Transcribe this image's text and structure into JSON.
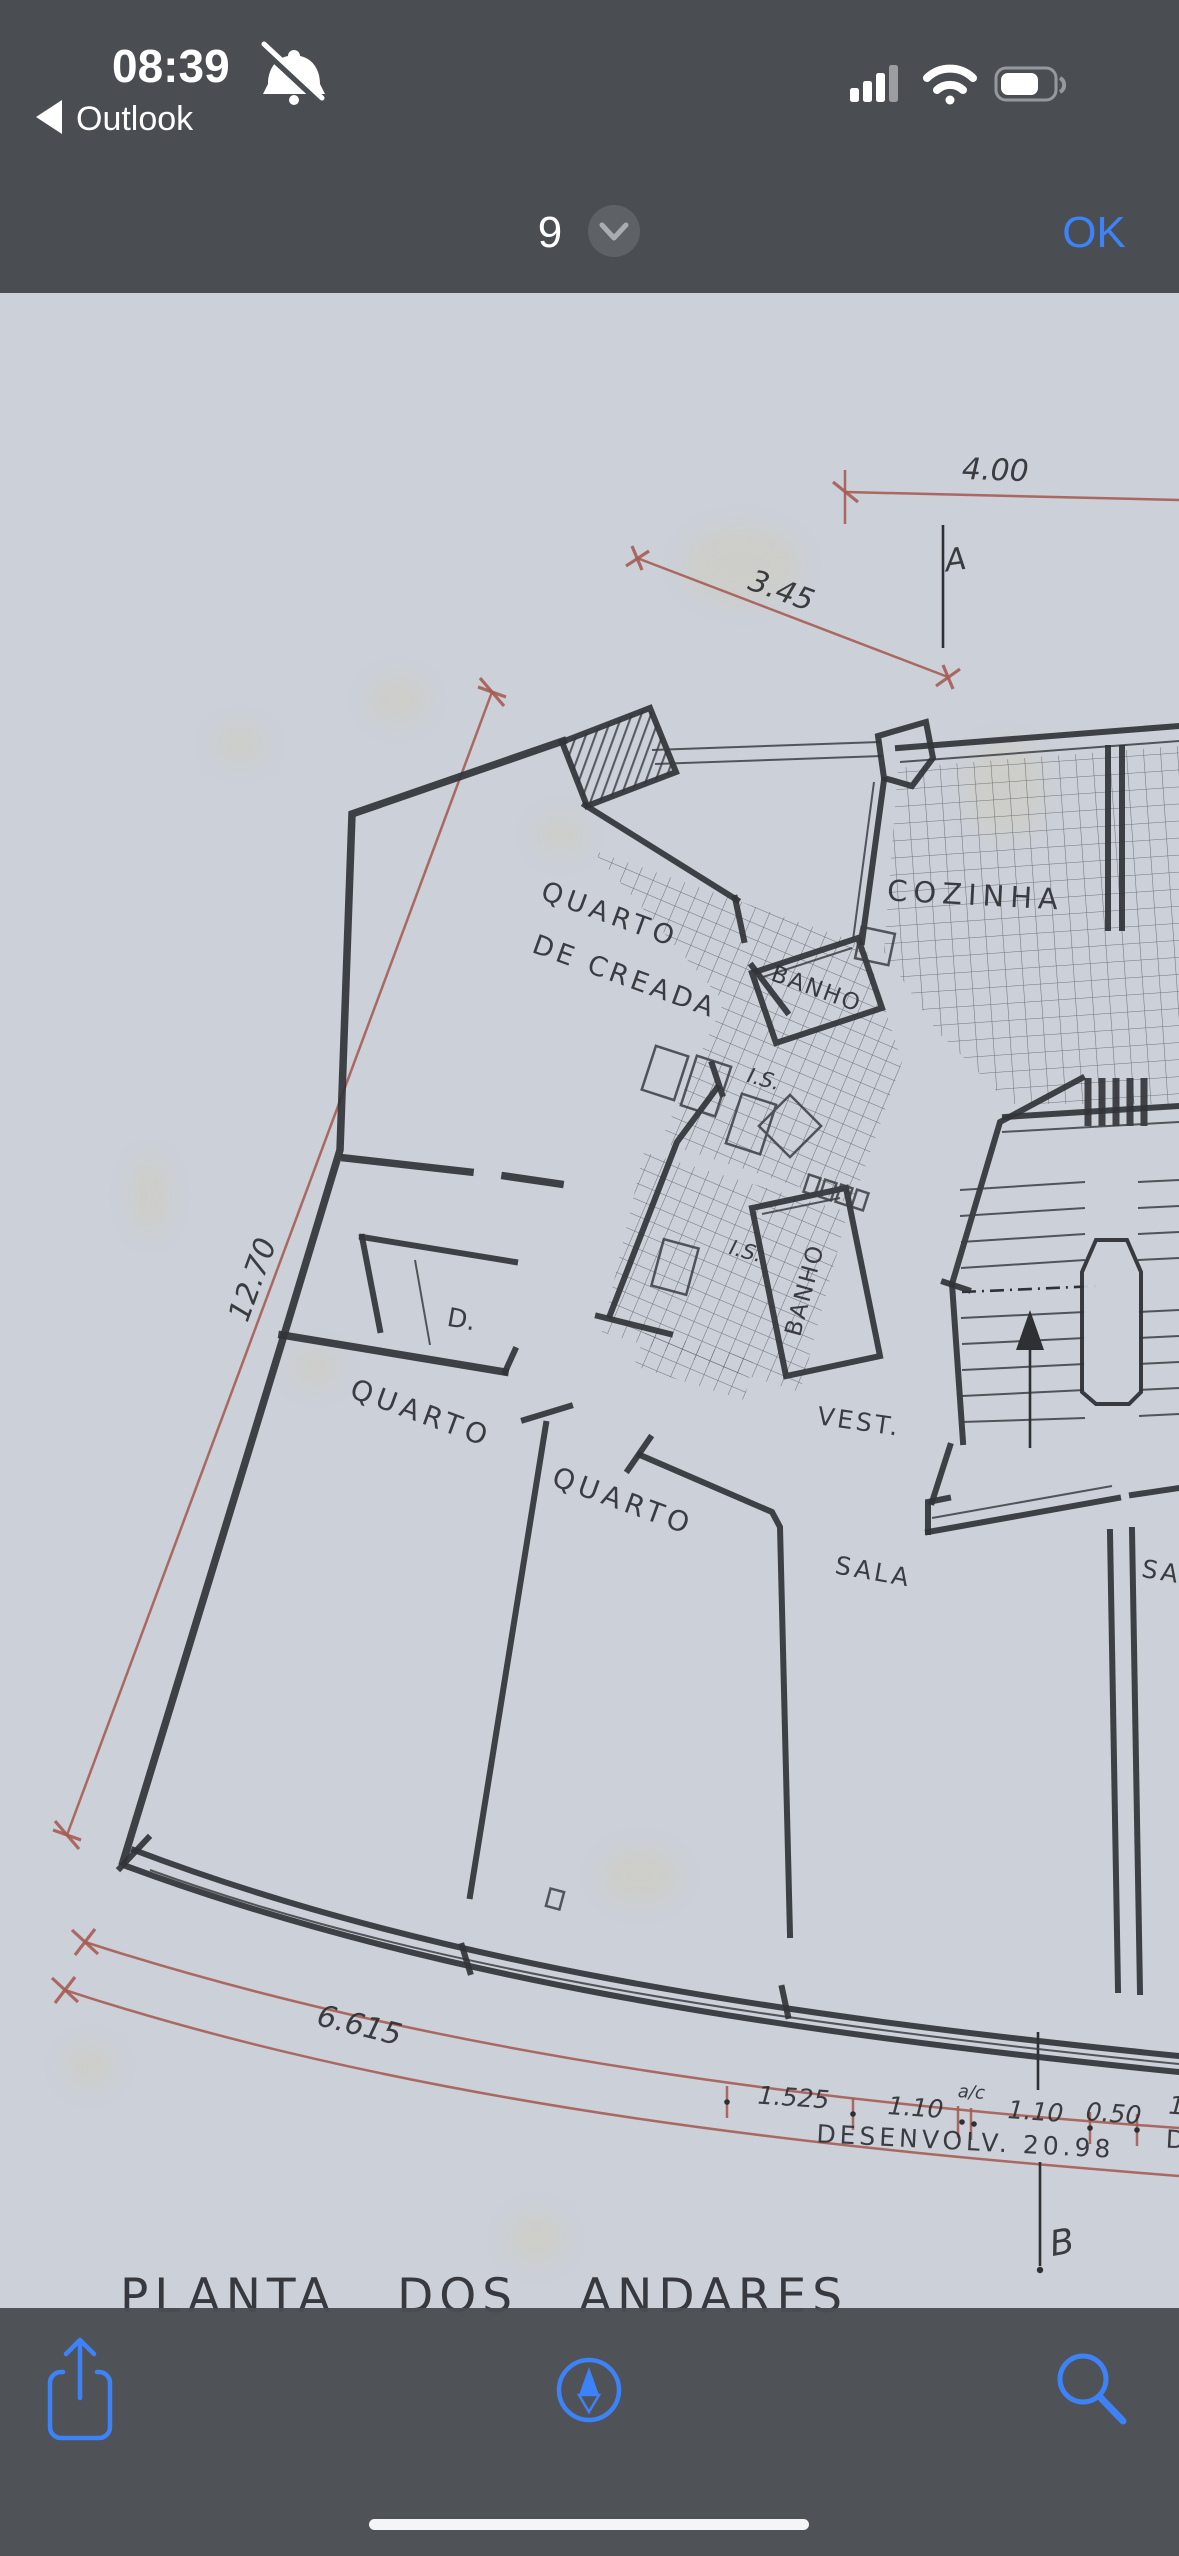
{
  "status_bar": {
    "time": "08:39",
    "back_label": "Outlook"
  },
  "nav_bar": {
    "page_number": "9",
    "ok_label": "OK"
  },
  "plan": {
    "rooms": {
      "maid_line1": "QUARTO",
      "maid_line2": "DE CREADA",
      "bath_upper": "BANHO",
      "is_upper": "I.S.",
      "is_lower": "I.S.",
      "bath_lower": "BANHO",
      "kitchen": "COZINHA",
      "closet": "D.",
      "bedroom_left": "QUARTO",
      "bedroom_mid": "QUARTO",
      "vestibule": "VEST.",
      "living": "SALA",
      "living_partial": "SA"
    },
    "dimensions": {
      "top": "4.00",
      "upper_diagonal": "3.45",
      "left_diagonal": "12.70",
      "bottom_arc": "6.615",
      "segments": [
        "1.525",
        "1.10",
        "1.10",
        "0.50"
      ],
      "segment_note": "a/c",
      "segment_partial": "1",
      "development": "DESENVOLV. 20.98",
      "right_edge_partial": "D"
    },
    "sections": {
      "a": "A",
      "b": "B"
    },
    "title": "PLANTA DOS ANDARES"
  },
  "toolbar": {
    "icons": [
      "share-icon",
      "compass-icon",
      "search-icon"
    ]
  },
  "colors": {
    "accent_blue": "#3E82F7",
    "chrome": "#4A4E52",
    "paper": "#CBD0D9",
    "ink": "#313338",
    "dim_red": "#A65C52"
  }
}
